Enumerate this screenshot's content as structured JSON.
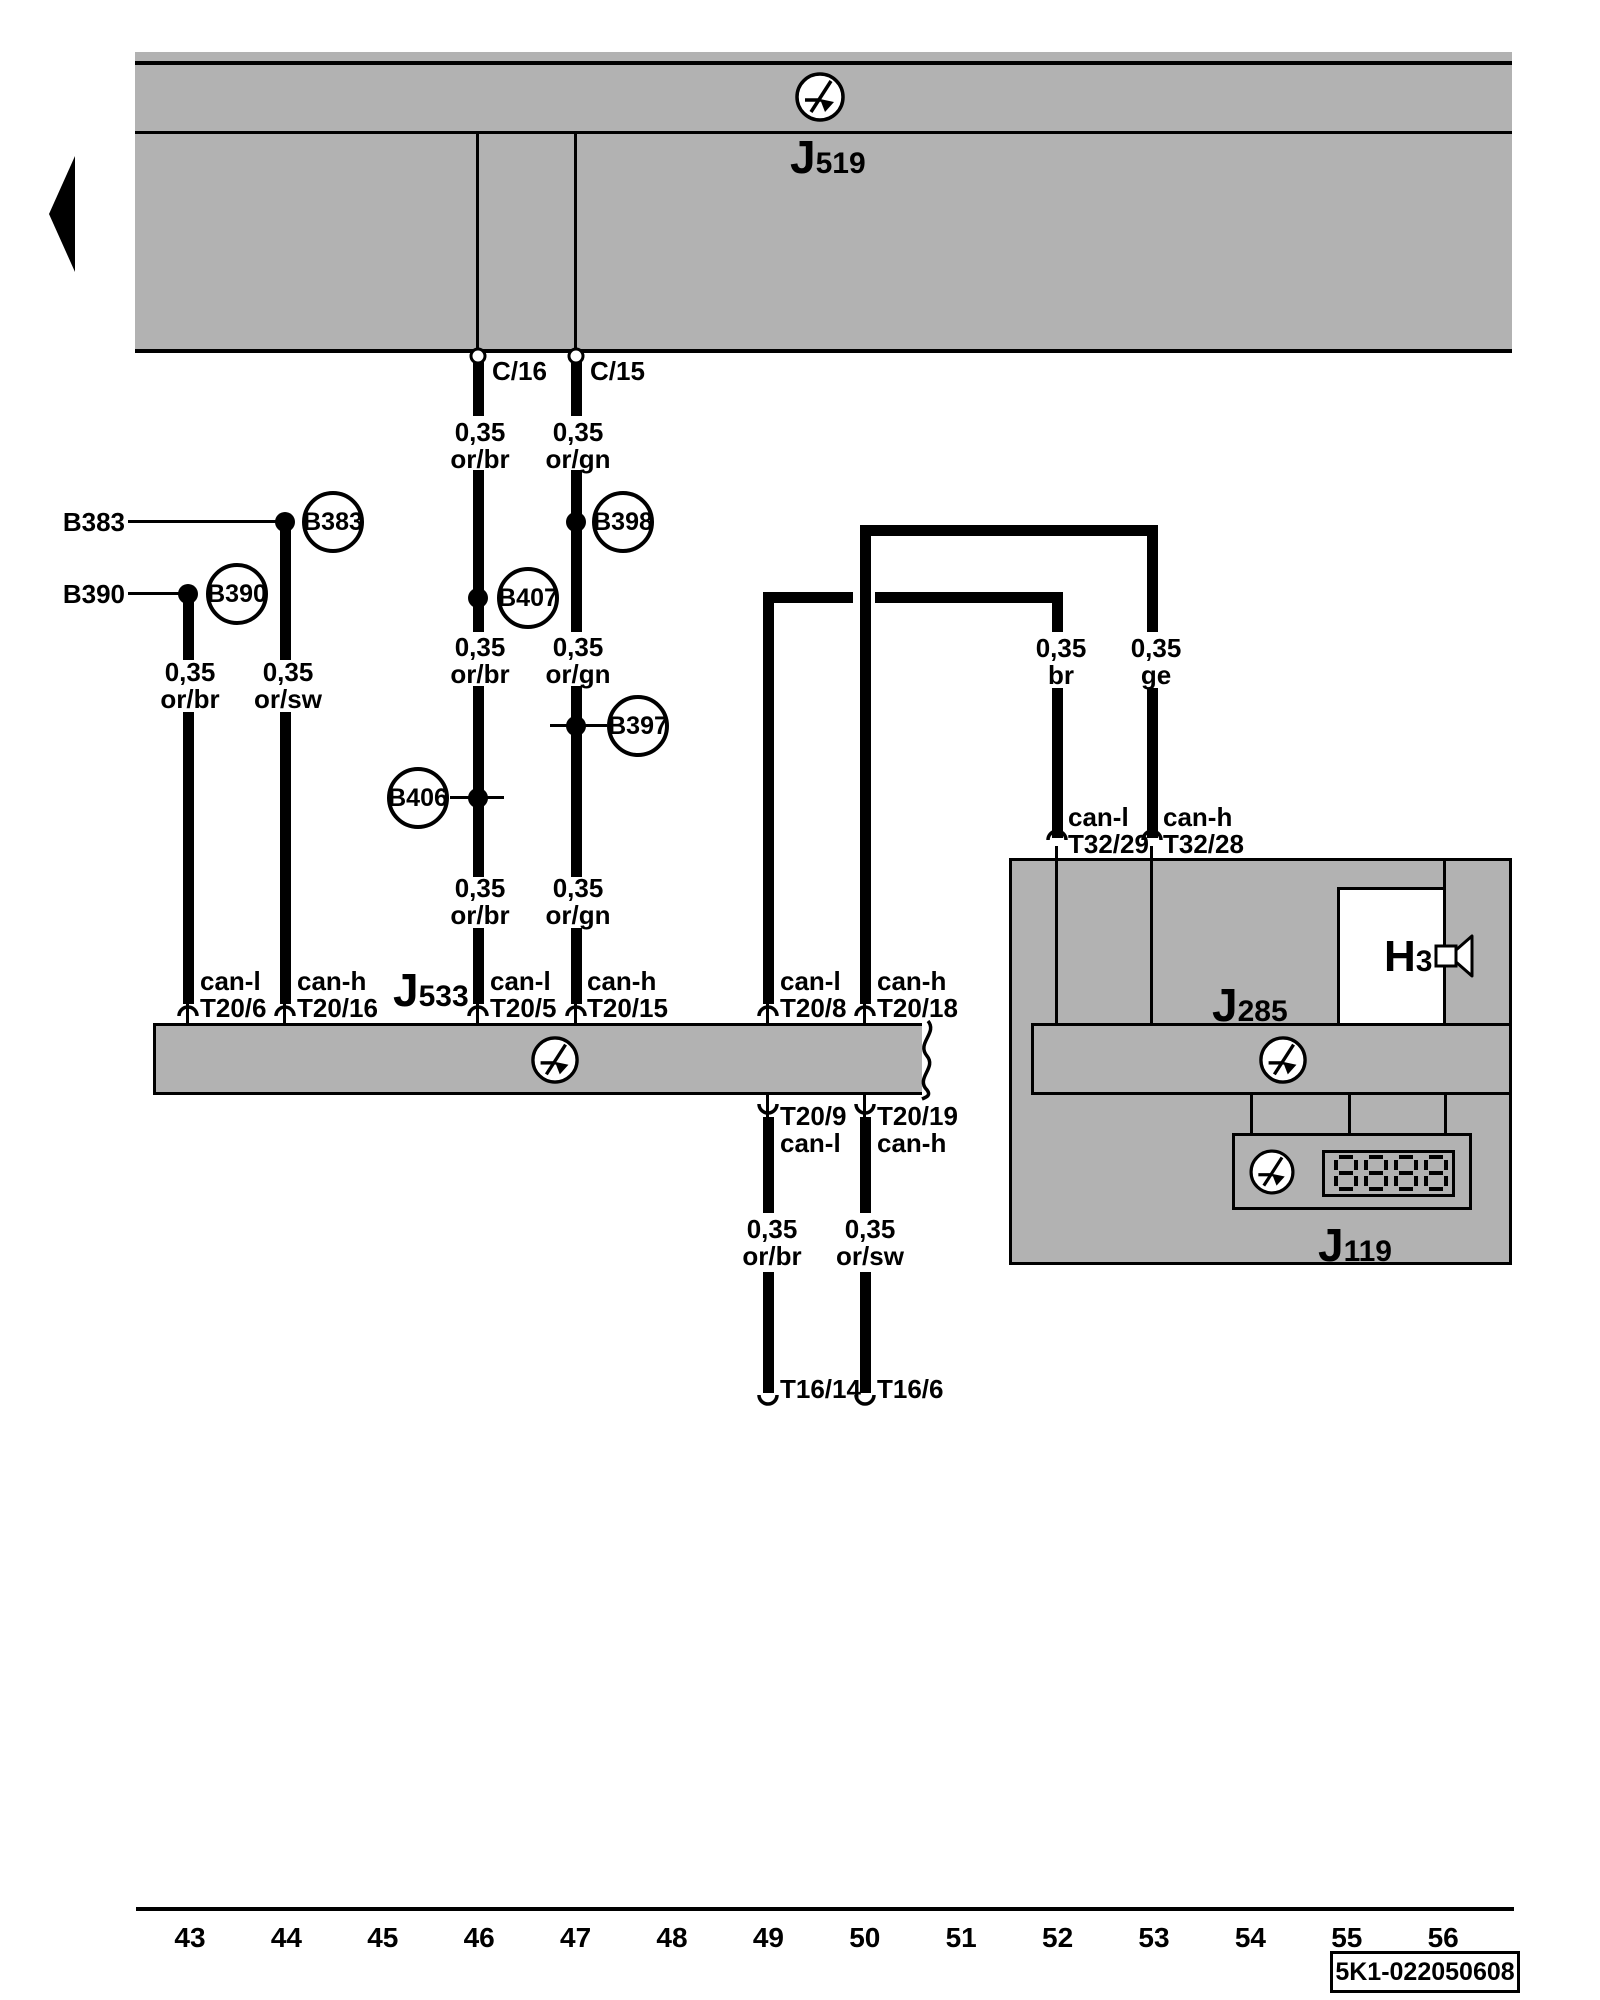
{
  "components": {
    "j519": {
      "prefix": "J",
      "sub": "519"
    },
    "j533": {
      "prefix": "J",
      "sub": "533"
    },
    "j285": {
      "prefix": "J",
      "sub": "285"
    },
    "j119": {
      "prefix": "J",
      "sub": "119",
      "display": "8888"
    },
    "h3": {
      "prefix": "H",
      "sub": "3"
    }
  },
  "connectors": {
    "c16": "C/16",
    "c15": "C/15"
  },
  "splices": {
    "b383": {
      "label": "B383",
      "wire_tag": "B383"
    },
    "b390": {
      "label": "B390",
      "wire_tag": "B390"
    },
    "b398": {
      "label": "B398"
    },
    "b407": {
      "label": "B407"
    },
    "b397": {
      "label": "B397"
    },
    "b406": {
      "label": "B406"
    }
  },
  "wire_labels": {
    "c16_a": {
      "size": "0,35",
      "color": "or/br"
    },
    "c16_b": {
      "size": "0,35",
      "color": "or/br"
    },
    "c16_c": {
      "size": "0,35",
      "color": "or/br"
    },
    "c15_a": {
      "size": "0,35",
      "color": "or/gn"
    },
    "c15_b": {
      "size": "0,35",
      "color": "or/gn"
    },
    "c15_c": {
      "size": "0,35",
      "color": "or/gn"
    },
    "left_a": {
      "size": "0,35",
      "color": "or/br"
    },
    "left_b": {
      "size": "0,35",
      "color": "or/sw"
    },
    "right_br": {
      "size": "0,35",
      "color": "br"
    },
    "right_ge": {
      "size": "0,35",
      "color": "ge"
    },
    "lower_a": {
      "size": "0,35",
      "color": "or/br"
    },
    "lower_b": {
      "size": "0,35",
      "color": "or/sw"
    }
  },
  "pins": {
    "t20_6": {
      "bus": "can-l",
      "pin": "T20/6"
    },
    "t20_16": {
      "bus": "can-h",
      "pin": "T20/16"
    },
    "t20_5": {
      "bus": "can-l",
      "pin": "T20/5"
    },
    "t20_15": {
      "bus": "can-h",
      "pin": "T20/15"
    },
    "t20_8": {
      "bus": "can-l",
      "pin": "T20/8"
    },
    "t20_18": {
      "bus": "can-h",
      "pin": "T20/18"
    },
    "t32_29": {
      "bus": "can-l",
      "pin": "T32/29"
    },
    "t32_28": {
      "bus": "can-h",
      "pin": "T32/28"
    },
    "t20_9": {
      "pin": "T20/9",
      "bus": "can-l"
    },
    "t20_19": {
      "pin": "T20/19",
      "bus": "can-h"
    },
    "t16_14": {
      "pin": "T16/14"
    },
    "t16_6": {
      "pin": "T16/6"
    }
  },
  "scale": {
    "numbers": [
      "43",
      "44",
      "45",
      "46",
      "47",
      "48",
      "49",
      "50",
      "51",
      "52",
      "53",
      "54",
      "55",
      "56"
    ]
  },
  "footer": {
    "code": "5K1-022050608"
  },
  "colors": {
    "gray": "#b2b2b2",
    "ink": "#000000",
    "paper": "#ffffff"
  }
}
